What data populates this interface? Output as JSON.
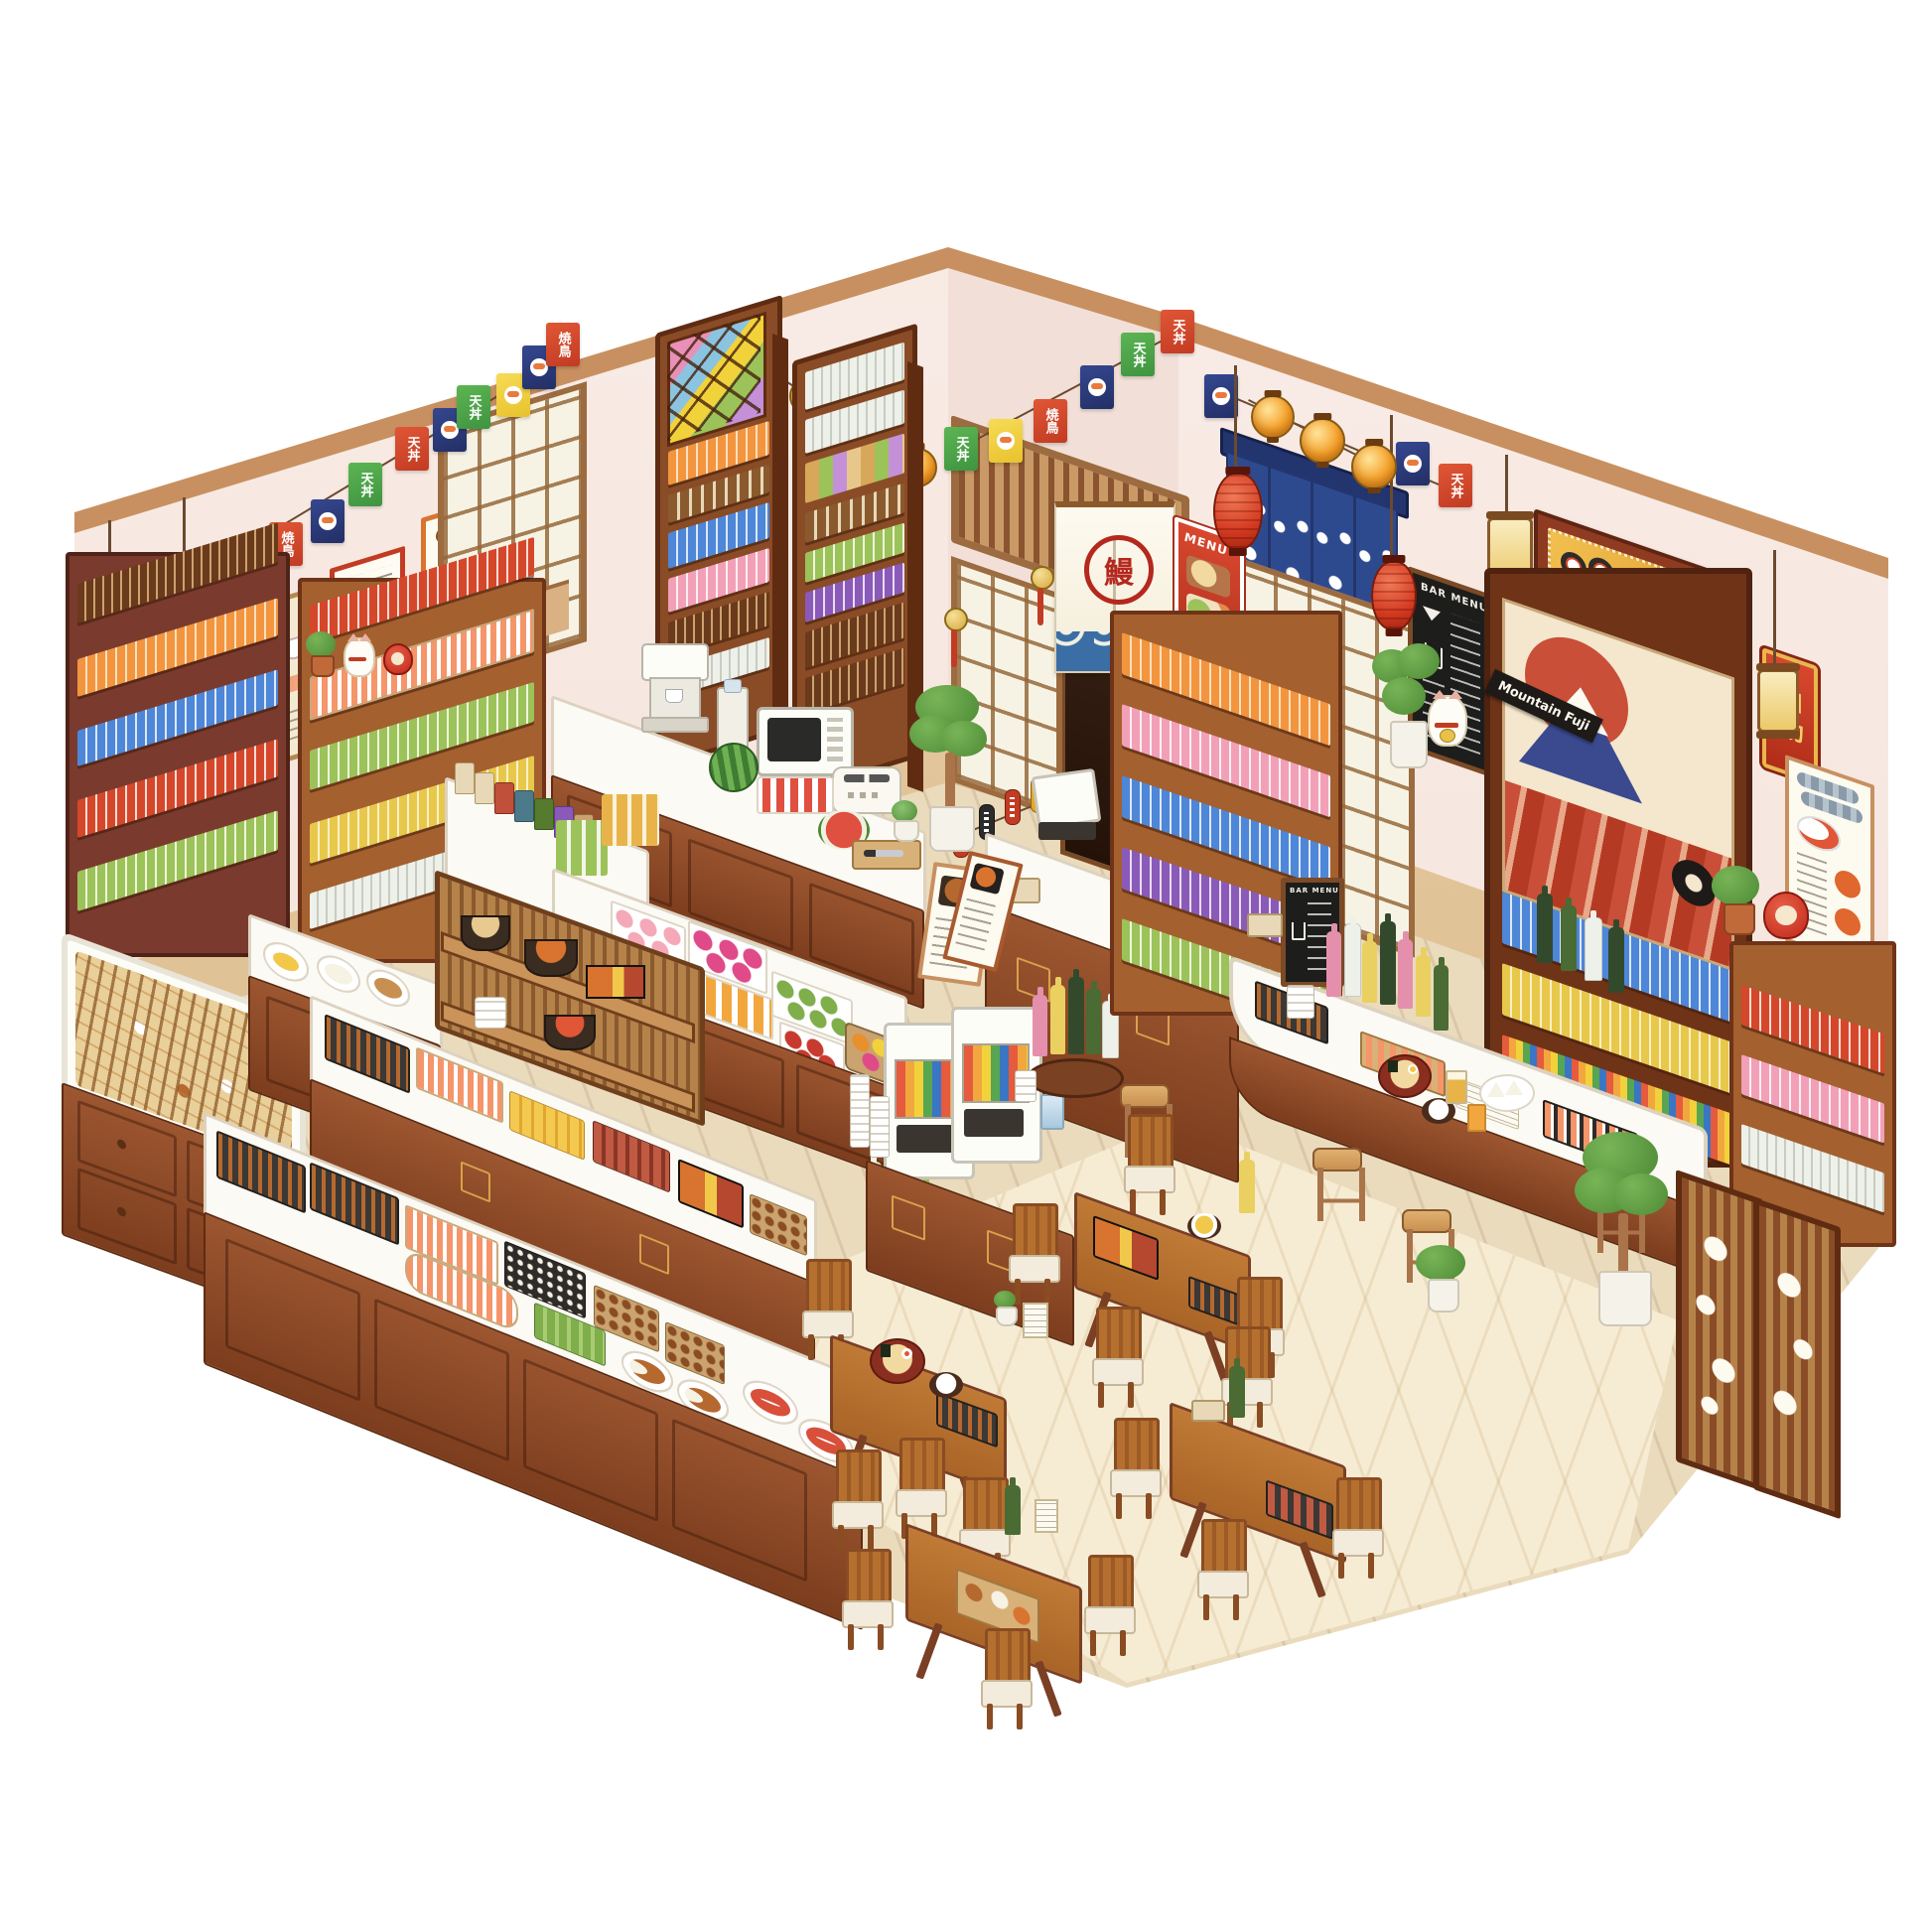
{
  "signs": {
    "izakaya": "居酒屋",
    "self_service": "自助",
    "bar_menu_wall": "BAR MENU",
    "bar_menu_counter": "BAR MENU",
    "menu_poster": "MENU",
    "mountain_fuji": "Mountain Fuji",
    "entrance_noren": "鰻"
  },
  "banners": {
    "left_wall": [
      {
        "color": "#4ea84e",
        "label": "天丼"
      },
      {
        "color": "#f2d23b",
        "label": ""
      },
      {
        "color": "#d5472b",
        "label": "焼鳥"
      },
      {
        "color": "#2c3d7a",
        "label": ""
      },
      {
        "color": "#4ea84e",
        "label": "天丼"
      },
      {
        "color": "#d5472b",
        "label": "天丼"
      },
      {
        "color": "#2c3d7a",
        "label": ""
      },
      {
        "color": "#4ea84e",
        "label": "天丼"
      },
      {
        "color": "#f2d23b",
        "label": ""
      },
      {
        "color": "#2c3d7a",
        "label": ""
      },
      {
        "color": "#d5472b",
        "label": "焼鳥"
      }
    ],
    "corner_wall": [
      {
        "color": "#4ea84e",
        "label": "天丼"
      },
      {
        "color": "#f2d23b",
        "label": ""
      },
      {
        "color": "#d5472b",
        "label": "焼鳥"
      },
      {
        "color": "#2c3d7a",
        "label": ""
      },
      {
        "color": "#4ea84e",
        "label": "天丼"
      },
      {
        "color": "#d5472b",
        "label": "天丼"
      }
    ],
    "right_wall": [
      {
        "color": "#2c3d7a",
        "label": ""
      },
      {
        "color": "#2c3d7a",
        "label": ""
      },
      {
        "color": "#d5472b",
        "label": "天丼"
      }
    ]
  },
  "palette": {
    "wall": "#f7e8e1",
    "beam": "#c89060",
    "wood_dark": "#6f3318",
    "wood": "#8e4a2a",
    "wood_light": "#b5702f",
    "counter_top": "#fbfaf4",
    "floor": "#eadbbc",
    "rug": "#f6ecd4",
    "accent_red": "#c23b22",
    "noren_blue": "#2e4a8f",
    "flag_green": "#4ea84e",
    "flag_yellow": "#f2d23b",
    "flag_red": "#d5472b",
    "flag_navy": "#2c3d7a",
    "lantern_orange": "#f5a22c",
    "sign_gold": "#e2a93a"
  }
}
